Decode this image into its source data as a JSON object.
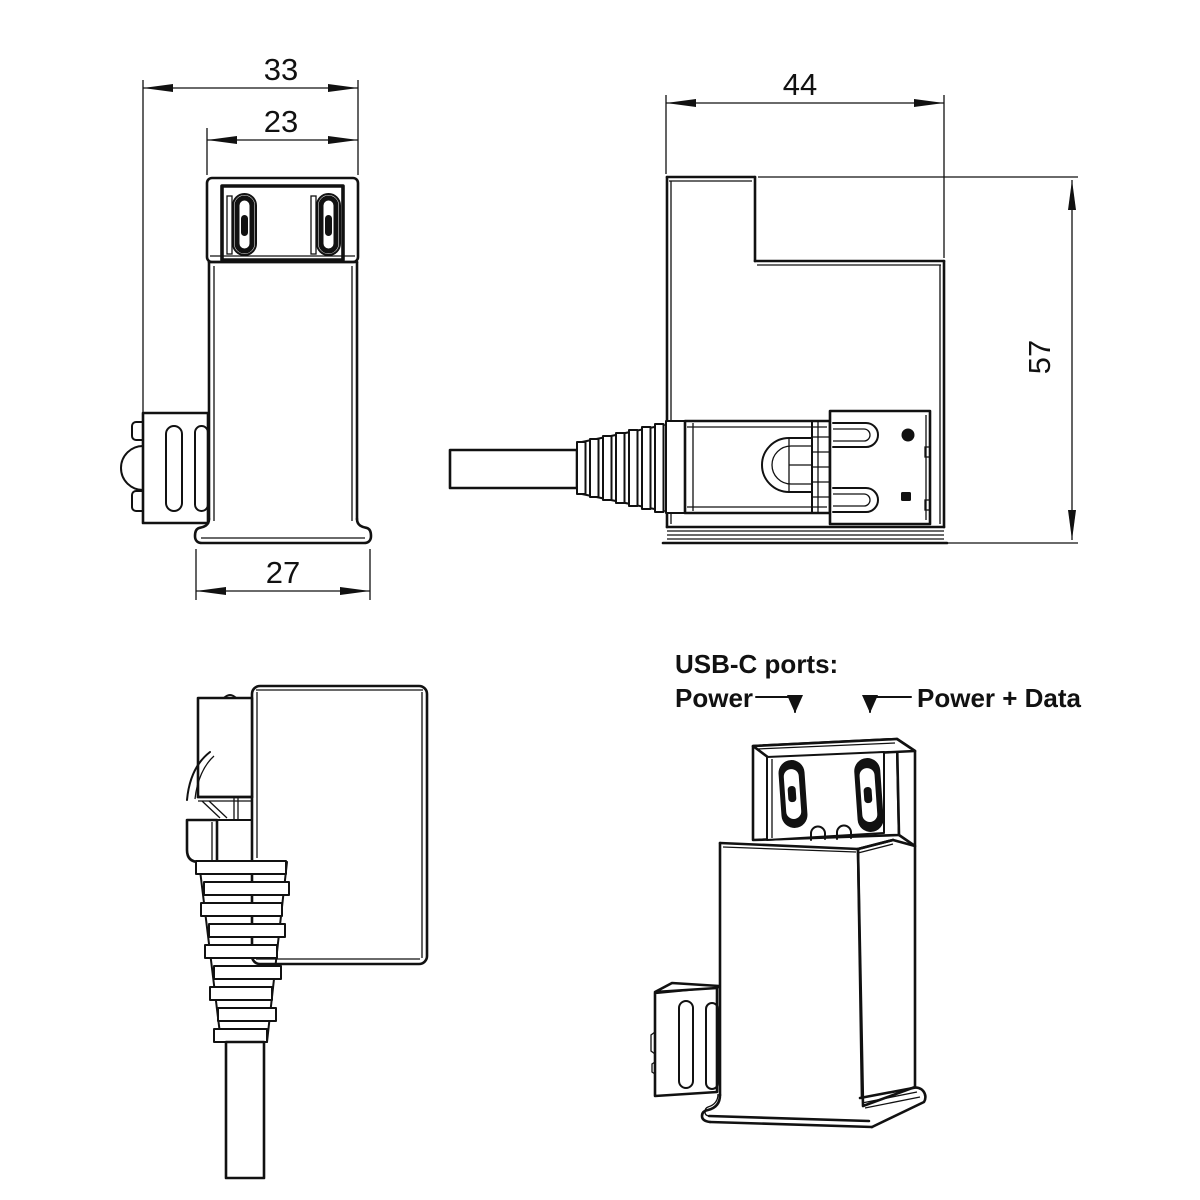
{
  "colors": {
    "line": "#111111",
    "background": "#ffffff",
    "port_fill": "#111111"
  },
  "dimensions": {
    "total_width_mm": "33",
    "head_width_mm": "23",
    "base_width_mm": "27",
    "depth_mm": "44",
    "height_mm": "57"
  },
  "labels": {
    "ports_heading": "USB-C ports:",
    "port_left": "Power",
    "port_right": "Power + Data"
  }
}
